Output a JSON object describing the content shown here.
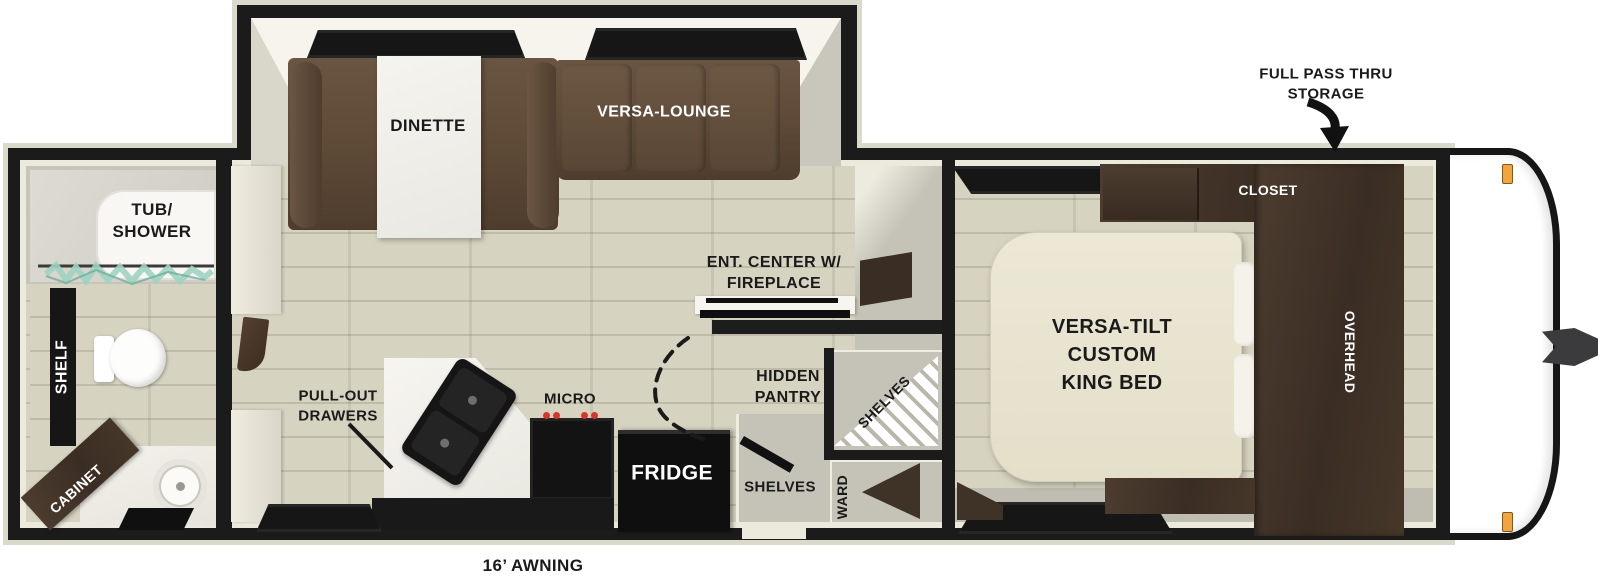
{
  "diagram": {
    "type": "rv-travel-trailer-floorplan",
    "exterior": {
      "full_pass_thru": "FULL PASS THRU\nSTORAGE",
      "awning": "16’ AWNING"
    },
    "rooms": {
      "bathroom": {
        "tub_shower": "TUB/\nSHOWER",
        "shelf": "SHELF",
        "cabinet": "CABINET"
      },
      "living": {
        "dinette": "DINETTE",
        "versa_lounge": "VERSA-LOUNGE",
        "ent_center": "ENT. CENTER W/\nFIREPLACE",
        "hidden_pantry": "HIDDEN\nPANTRY",
        "pull_out_drawers": "PULL-OUT\nDRAWERS",
        "micro": "MICRO",
        "fridge": "FRIDGE",
        "shelves_entry": "SHELVES",
        "shelves_corner": "SHELVES",
        "ward": "WARD"
      },
      "bedroom": {
        "king_bed": "VERSA-TILT\nCUSTOM\nKING BED",
        "closet": "CLOSET",
        "overhead": "OVERHEAD"
      }
    },
    "palette": {
      "wall_black": "#1b1b1b",
      "trim_cream": "#ece9dd",
      "floor_tan": "#d7d3c1",
      "interior_gray": "#c5c2b7",
      "sofa_brown": "#5d4936",
      "cabinet_brown": "#3f3226",
      "bed_cream": "#e9e5d1",
      "appliance_black": "#121212",
      "curtain_teal": "#9fd2c2",
      "marker_orange": "#f2a53e"
    }
  }
}
